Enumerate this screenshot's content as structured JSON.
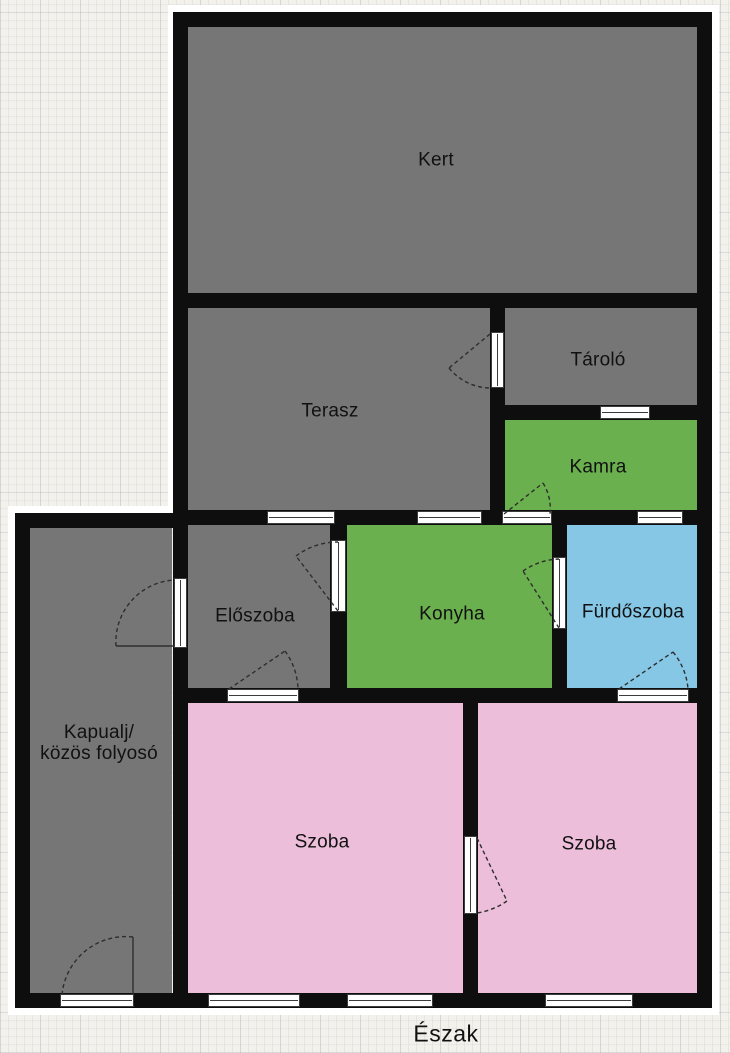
{
  "title": "Floor plan",
  "compass": {
    "label": "Észak"
  },
  "colors": {
    "paper": "#f2f1ec",
    "wall": "#0e0e0e",
    "line": "#2e2e2e",
    "halo": "#ffffff",
    "room_gray": "#767676",
    "room_green": "#6bb04e",
    "room_blue": "#85c7e4",
    "room_pink": "#ecbeda"
  },
  "rooms": [
    {
      "id": "kert",
      "label": "Kert",
      "fill": "room_gray",
      "rect": {
        "x": 188,
        "y": 27,
        "w": 509,
        "h": 266
      },
      "label_at": {
        "x": 436,
        "y": 160
      }
    },
    {
      "id": "terasz",
      "label": "Terasz",
      "fill": "room_gray",
      "rect": {
        "x": 188,
        "y": 308,
        "w": 302,
        "h": 202
      },
      "label_at": {
        "x": 330,
        "y": 411
      }
    },
    {
      "id": "tarolo",
      "label": "Tároló",
      "fill": "room_gray",
      "rect": {
        "x": 505,
        "y": 308,
        "w": 192,
        "h": 97
      },
      "label_at": {
        "x": 598,
        "y": 360
      }
    },
    {
      "id": "kamra",
      "label": "Kamra",
      "fill": "room_green",
      "rect": {
        "x": 505,
        "y": 420,
        "w": 192,
        "h": 90
      },
      "label_at": {
        "x": 598,
        "y": 467
      }
    },
    {
      "id": "eloszoba",
      "label": "Előszoba",
      "fill": "room_gray",
      "rect": {
        "x": 188,
        "y": 525,
        "w": 142,
        "h": 163
      },
      "label_at": {
        "x": 255,
        "y": 616
      }
    },
    {
      "id": "konyha",
      "label": "Konyha",
      "fill": "room_green",
      "rect": {
        "x": 347,
        "y": 525,
        "w": 205,
        "h": 163
      },
      "label_at": {
        "x": 452,
        "y": 614
      }
    },
    {
      "id": "furdoszoba",
      "label": "Fürdőszoba",
      "fill": "room_blue",
      "rect": {
        "x": 567,
        "y": 525,
        "w": 130,
        "h": 163
      },
      "label_at": {
        "x": 633,
        "y": 612
      }
    },
    {
      "id": "kapualj",
      "label": "Kapualj/ közös folyosó",
      "label_lines": [
        "Kapualj/",
        "közös folyosó"
      ],
      "fill": "room_gray",
      "rect": {
        "x": 30,
        "y": 528,
        "w": 142,
        "h": 465
      },
      "label_at": {
        "x": 99,
        "y": 743
      }
    },
    {
      "id": "szoba-1",
      "label": "Szoba",
      "fill": "room_pink",
      "rect": {
        "x": 188,
        "y": 703,
        "w": 275,
        "h": 290
      },
      "label_at": {
        "x": 322,
        "y": 842
      }
    },
    {
      "id": "szoba-2",
      "label": "Szoba",
      "fill": "room_pink",
      "rect": {
        "x": 478,
        "y": 703,
        "w": 219,
        "h": 290
      },
      "label_at": {
        "x": 589,
        "y": 844
      }
    }
  ],
  "walls": [
    {
      "id": "top",
      "x": 173,
      "y": 12,
      "w": 539,
      "h": 15
    },
    {
      "id": "right",
      "x": 697,
      "y": 12,
      "w": 15,
      "h": 996
    },
    {
      "id": "left-upper",
      "x": 173,
      "y": 12,
      "w": 15,
      "h": 516
    },
    {
      "id": "kert-bottom",
      "x": 173,
      "y": 293,
      "w": 539,
      "h": 15
    },
    {
      "id": "terasz-tarolo",
      "x": 490,
      "y": 293,
      "w": 15,
      "h": 232
    },
    {
      "id": "tarolo-kamra",
      "x": 505,
      "y": 405,
      "w": 207,
      "h": 15
    },
    {
      "id": "middle",
      "x": 173,
      "y": 510,
      "w": 539,
      "h": 15
    },
    {
      "id": "eloszoba-konyha",
      "x": 330,
      "y": 510,
      "w": 17,
      "h": 193
    },
    {
      "id": "konyha-furdoszoba",
      "x": 552,
      "y": 510,
      "w": 15,
      "h": 193
    },
    {
      "id": "middle-bottom",
      "x": 173,
      "y": 688,
      "w": 539,
      "h": 15
    },
    {
      "id": "kapualj-top",
      "x": 15,
      "y": 513,
      "w": 160,
      "h": 15
    },
    {
      "id": "kapualj-left",
      "x": 15,
      "y": 513,
      "w": 15,
      "h": 495
    },
    {
      "id": "kapualj-szoba",
      "x": 173,
      "y": 528,
      "w": 15,
      "h": 465
    },
    {
      "id": "szoba-szoba",
      "x": 463,
      "y": 688,
      "w": 15,
      "h": 305
    },
    {
      "id": "bottom",
      "x": 15,
      "y": 993,
      "w": 697,
      "h": 15
    }
  ],
  "halo_strips": [
    {
      "x": 168,
      "y": 5,
      "w": 551,
      "h": 7
    },
    {
      "x": 712,
      "y": 5,
      "w": 7,
      "h": 1010
    },
    {
      "x": 8,
      "y": 1008,
      "w": 711,
      "h": 7
    },
    {
      "x": 168,
      "y": 5,
      "w": 7,
      "h": 505
    },
    {
      "x": 8,
      "y": 506,
      "w": 167,
      "h": 7
    },
    {
      "x": 8,
      "y": 506,
      "w": 7,
      "h": 505
    }
  ],
  "openings": [
    {
      "id": "tarolo-kamra",
      "kind": "window",
      "orient": "h",
      "x": 600,
      "y": 406,
      "w": 50,
      "h": 13
    },
    {
      "id": "terasz-eloszoba",
      "kind": "window",
      "orient": "h",
      "x": 267,
      "y": 511,
      "w": 68,
      "h": 13
    },
    {
      "id": "terasz-konyha",
      "kind": "window",
      "orient": "h",
      "x": 417,
      "y": 511,
      "w": 65,
      "h": 13
    },
    {
      "id": "kamra-furdoszoba",
      "kind": "window",
      "orient": "h",
      "x": 637,
      "y": 511,
      "w": 46,
      "h": 13
    },
    {
      "id": "szoba-1-a",
      "kind": "window",
      "orient": "h",
      "x": 208,
      "y": 994,
      "w": 92,
      "h": 13
    },
    {
      "id": "szoba-1-b",
      "kind": "window",
      "orient": "h",
      "x": 347,
      "y": 994,
      "w": 86,
      "h": 13
    },
    {
      "id": "szoba-2",
      "kind": "window",
      "orient": "h",
      "x": 545,
      "y": 994,
      "w": 88,
      "h": 13
    },
    {
      "id": "terasz-tarolo",
      "kind": "door",
      "orient": "v",
      "x": 491,
      "y": 332,
      "w": 13,
      "h": 56
    },
    {
      "id": "kamra",
      "kind": "door",
      "orient": "h",
      "x": 502,
      "y": 511,
      "w": 50,
      "h": 13
    },
    {
      "id": "eloszoba-konyha",
      "kind": "door",
      "orient": "v",
      "x": 331,
      "y": 540,
      "w": 15,
      "h": 72
    },
    {
      "id": "eloszoba-szoba",
      "kind": "door",
      "orient": "h",
      "x": 227,
      "y": 689,
      "w": 72,
      "h": 13
    },
    {
      "id": "konyha-furdoszoba",
      "kind": "door",
      "orient": "v",
      "x": 553,
      "y": 557,
      "w": 13,
      "h": 72
    },
    {
      "id": "furdoszoba-szoba",
      "kind": "door",
      "orient": "h",
      "x": 617,
      "y": 689,
      "w": 72,
      "h": 13
    },
    {
      "id": "szoba-szoba",
      "kind": "door",
      "orient": "v",
      "x": 464,
      "y": 836,
      "w": 13,
      "h": 78
    },
    {
      "id": "kapualj-eloszoba",
      "kind": "door",
      "orient": "v",
      "x": 174,
      "y": 578,
      "w": 13,
      "h": 70
    },
    {
      "id": "entrance",
      "kind": "door",
      "orient": "h",
      "x": 60,
      "y": 994,
      "w": 74,
      "h": 13
    }
  ],
  "door_swings": [
    {
      "id": "terasz-tarolo",
      "leaf": "M490,334 L449,368",
      "arc": "M449,368 A54,54 0 0 0 490,388",
      "leaf_dashed": true
    },
    {
      "id": "kamra",
      "leaf": "M504,514 L543,483",
      "arc": "M543,483 A48,48 0 0 1 550,514",
      "leaf_dashed": true
    },
    {
      "id": "eloszoba-konyha",
      "leaf": "M338,611 L296,556",
      "arc": "M296,556 A69,69 0 0 1 338,542",
      "leaf_dashed": true
    },
    {
      "id": "eloszoba-szoba",
      "leaf": "M229,689 L285,651",
      "arc": "M285,651 A68,68 0 0 1 298,689",
      "leaf_dashed": true
    },
    {
      "id": "konyha-furdoszoba",
      "leaf": "M559,628 L523,571",
      "arc": "M523,571 A67,67 0 0 1 559,559",
      "leaf_dashed": true
    },
    {
      "id": "furdoszoba-szoba",
      "leaf": "M619,689 L673,652",
      "arc": "M673,652 A66,66 0 0 1 688,689",
      "leaf_dashed": true
    },
    {
      "id": "szoba-szoba",
      "leaf": "M477,838 L507,901",
      "arc": "M507,901 A72,72 0 0 1 477,913",
      "leaf_dashed": true
    },
    {
      "id": "kapualj-eloszoba",
      "leaf": "M174,646 L116,646",
      "arc": "M116,646 A62,62 0 0 1 174,580",
      "leaf_dashed": false
    },
    {
      "id": "entrance",
      "leaf": "M133,995 L133,937",
      "arc": "M133,937 A64,64 0 0 0 62,995",
      "leaf_dashed": false
    }
  ],
  "compass_label_at": {
    "x": 446,
    "y": 1034
  }
}
